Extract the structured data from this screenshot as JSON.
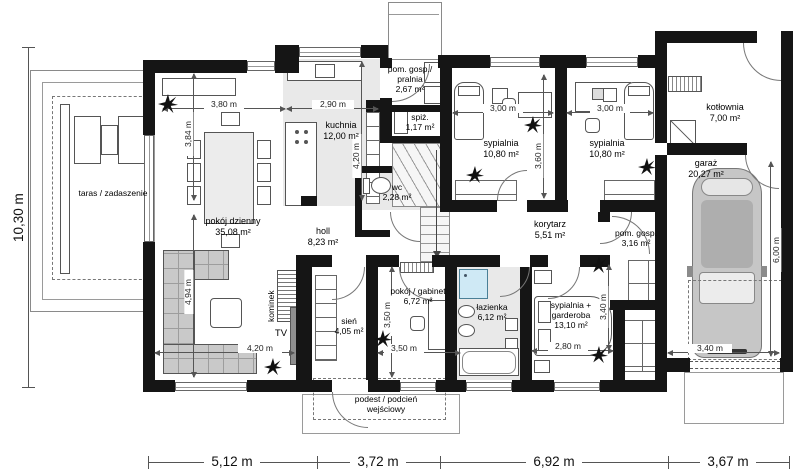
{
  "rooms": {
    "terrace": {
      "name": "taras / zadaszenie"
    },
    "living": {
      "name": "pokój dzienny",
      "area": "35,08 m²"
    },
    "kitchen": {
      "name": "kuchnia",
      "area": "12,00 m²"
    },
    "laundry": {
      "name": "pom. gosp./ pralnia",
      "area": "2,67 m²"
    },
    "pantry": {
      "name": "spiż.",
      "area": "1,17 m²"
    },
    "wc": {
      "name": "wc",
      "area": "2,28 m²"
    },
    "bedroom1": {
      "name": "sypialnia",
      "area": "10,80 m²"
    },
    "bedroom2": {
      "name": "sypialnia",
      "area": "10,80 m²"
    },
    "boiler": {
      "name": "kotłownia",
      "area": "7,00 m²"
    },
    "garage": {
      "name": "garaż",
      "area": "20,27 m²"
    },
    "corridor": {
      "name": "korytarz",
      "area": "5,51 m²"
    },
    "utility": {
      "name": "pom. gosp.",
      "area": "3,16 m²"
    },
    "hall": {
      "name": "holl",
      "area": "8,23 m²"
    },
    "vestibule": {
      "name": "sień",
      "area": "4,05 m²"
    },
    "office": {
      "name": "pokój / gabinet",
      "area": "6,72 m²"
    },
    "bathroom": {
      "name": "łazienka",
      "area": "6,12 m²"
    },
    "bedroom3": {
      "name": "sypialnia + garderoba",
      "area": "13,10 m²"
    },
    "porch": {
      "name": "podest / podcień wejściowy"
    },
    "fireplace": {
      "name": "kominek"
    },
    "tv": {
      "name": "TV"
    }
  },
  "dims": {
    "bottom": [
      "5,12 m",
      "3,72 m",
      "6,92 m",
      "3,67 m"
    ],
    "left_total": "10,30 m",
    "living_top": "3,80 m",
    "kitchen_top": "2,90 m",
    "living_upper": "3,84 m",
    "kitchen_depth": "4,20 m",
    "bedroom1_width": "3,00 m",
    "bedroom2_width": "3,00 m",
    "bedroom_depth": "3,60 m",
    "living_lower": "4,94 m",
    "tv_wall": "4,20 m",
    "vestibule_height": "3,50 m",
    "office_width": "3,50 m",
    "bedroom3_width": "2,80 m",
    "wardrobe_height": "3,40 m",
    "garage_door_width": "3,40 m",
    "garage_depth": "6,00 m"
  },
  "colors": {
    "walls": "#151515",
    "floor_tile": "#e9e9e9",
    "furniture_gray": "#c9c9c9",
    "shower_blue": "#cfe9f5",
    "car_body": "#c6c6c6",
    "dimension_lines": "#555555"
  }
}
